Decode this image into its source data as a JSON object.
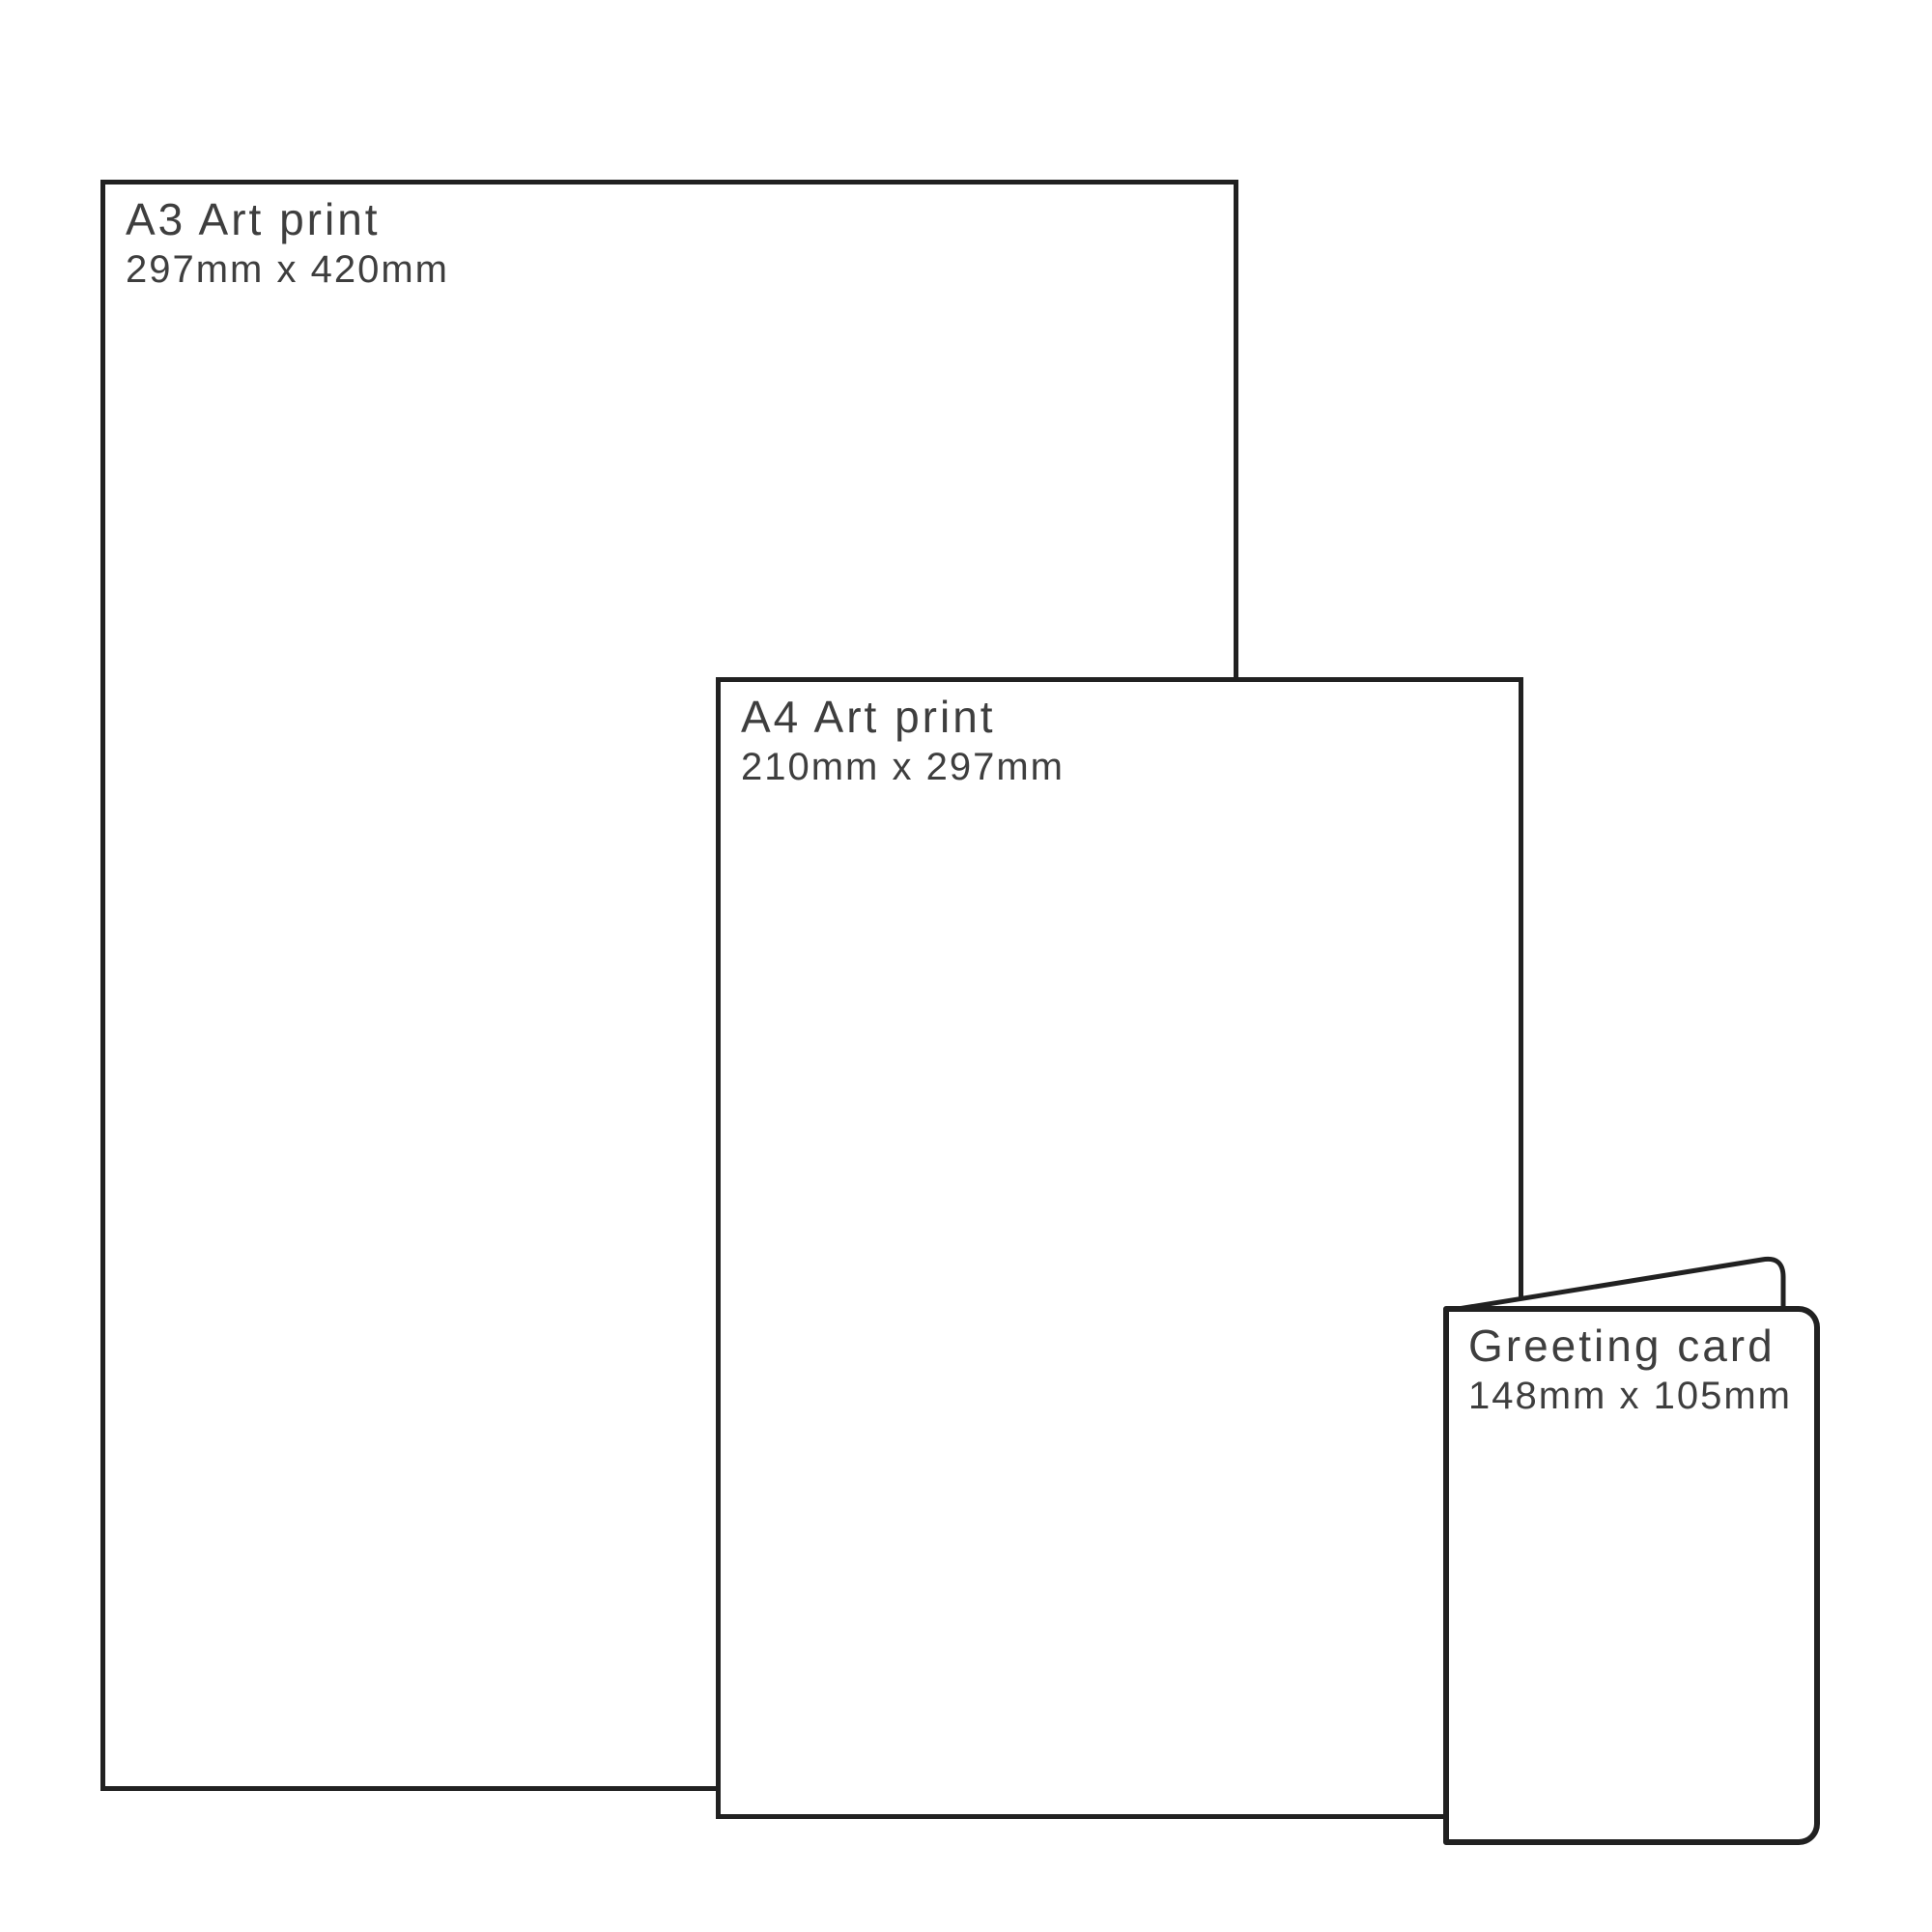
{
  "canvas": {
    "background": "#ffffff",
    "line_color": "#212121",
    "text_color": "#3e3e3e"
  },
  "panels": [
    {
      "id": "a3-art-print",
      "title": "A3 Art print",
      "dimensions": "297mm x 420mm"
    },
    {
      "id": "a4-art-print",
      "title": "A4 Art print",
      "dimensions": "210mm x 297mm"
    },
    {
      "id": "greeting-card",
      "title": "Greeting card",
      "dimensions": "148mm x 105mm"
    }
  ]
}
